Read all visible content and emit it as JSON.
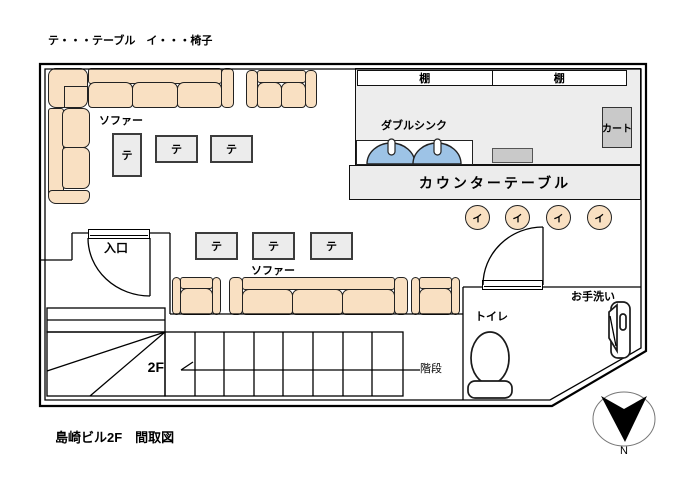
{
  "legend": "テ・・・テーブル　イ・・・椅子",
  "title": "島崎ビル2F　間取図",
  "labels": {
    "table": "テ",
    "chair": "イ",
    "sofa": "ソファー",
    "shelf": "棚",
    "double_sink": "ダブルシンク",
    "cart": "カート",
    "counter_table": "カウンターテーブル",
    "entrance": "入口",
    "toilet": "トイレ",
    "handwash": "お手洗い",
    "stairs": "階段",
    "floor": "2F",
    "north": "N"
  },
  "colors": {
    "sofa": "#f9e0c2",
    "sink": "#9dc3e6",
    "kitchen": "#ededed",
    "furniture_gray": "#ececec",
    "appliance": "#c9c9c9"
  }
}
